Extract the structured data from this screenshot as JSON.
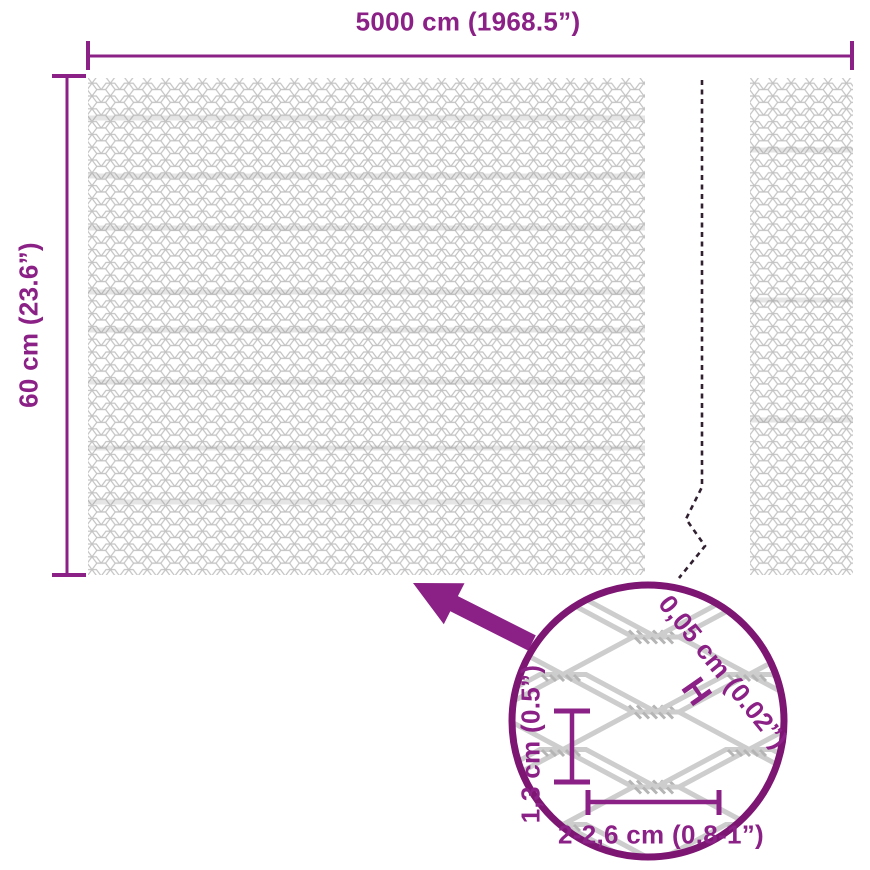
{
  "dimensions": {
    "width_label": "5000 cm (1968.5”)",
    "height_label": "60 cm (23.6”)"
  },
  "detail": {
    "wire_thickness_label": "0,05 cm (0.02”)",
    "wire_thickness_marker": "H",
    "cell_height_label": "1,3 cm (0.5”)",
    "cell_width_label": "2-2,6 cm (0.8-1”)"
  },
  "colors": {
    "accent_purple": "#8b2186",
    "ring_purple": "#7d1573",
    "break_line_dark": "#302030",
    "mesh_gray": "#c6c6c6"
  }
}
